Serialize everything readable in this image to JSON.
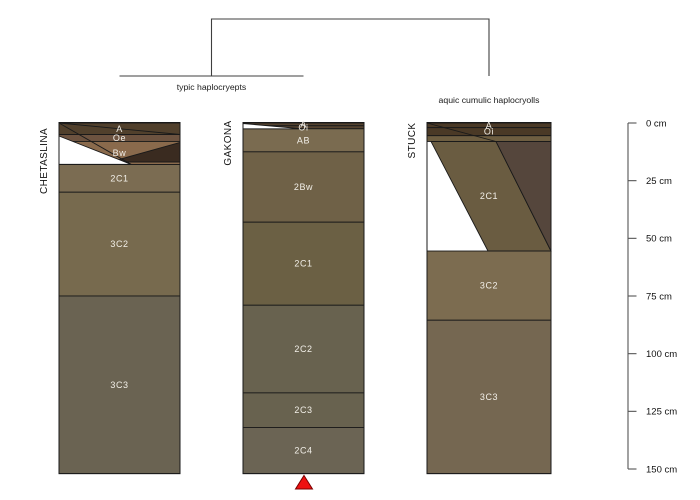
{
  "dendrogram": {
    "group_labels": [
      "typic haplocryepts",
      "aquic cumulic haplocryolls"
    ],
    "groups": [
      {
        "label": "typic haplocryepts",
        "members": [
          "CHETASLINA",
          "GAKONA"
        ]
      },
      {
        "label": "aquic cumulic haplocryolls",
        "members": [
          "STUCK"
        ]
      }
    ],
    "line_color": "#3f3f3f",
    "label_color": "#1a1a1a"
  },
  "depth_axis": {
    "unit": "cm",
    "ticks": [
      {
        "value": 0,
        "label": "0 cm"
      },
      {
        "value": 25,
        "label": "25 cm"
      },
      {
        "value": 50,
        "label": "50 cm"
      },
      {
        "value": 75,
        "label": "75 cm"
      },
      {
        "value": 100,
        "label": "100 cm"
      },
      {
        "value": 125,
        "label": "125 cm"
      },
      {
        "value": 150,
        "label": "150 cm"
      }
    ],
    "line_color": "#555555",
    "label_color": "#111111"
  },
  "profiles": [
    {
      "id": "CHETASLINA",
      "horizons": [
        {
          "name": "A",
          "top_cm": 0,
          "bottom_cm": 5,
          "color": "#51402c"
        },
        {
          "name": "Oe",
          "top_cm": 5,
          "bottom_cm": 8,
          "color": "#6d5340"
        },
        {
          "name": "Bw",
          "top_cm": 8,
          "bottom_cm": 18,
          "color": "#8a6a4c"
        },
        {
          "name": "2C1",
          "top_cm": 18,
          "bottom_cm": 30,
          "color": "#7b6c52"
        },
        {
          "name": "3C2",
          "top_cm": 30,
          "bottom_cm": 75,
          "color": "#776a4e"
        },
        {
          "name": "3C3",
          "top_cm": 75,
          "bottom_cm": 152,
          "color": "#6a6352"
        }
      ]
    },
    {
      "id": "GAKONA",
      "horizons": [
        {
          "name": "A",
          "top_cm": 0,
          "bottom_cm": 1.2,
          "color": "#54422f"
        },
        {
          "name": "Oi",
          "top_cm": 1.2,
          "bottom_cm": 2.5,
          "color": "#54422f"
        },
        {
          "name": "AB",
          "top_cm": 2.5,
          "bottom_cm": 12.5,
          "color": "#7a6b50"
        },
        {
          "name": "2Bw",
          "top_cm": 12.5,
          "bottom_cm": 43,
          "color": "#6f6147"
        },
        {
          "name": "2C1",
          "top_cm": 43,
          "bottom_cm": 79,
          "color": "#6b6044"
        },
        {
          "name": "2C2",
          "top_cm": 79,
          "bottom_cm": 117,
          "color": "#68624f"
        },
        {
          "name": "2C3",
          "top_cm": 117,
          "bottom_cm": 132,
          "color": "#68624f"
        },
        {
          "name": "2C4",
          "top_cm": 132,
          "bottom_cm": 152,
          "color": "#6b6454"
        }
      ]
    },
    {
      "id": "STUCK",
      "horizons": [
        {
          "name": "A",
          "top_cm": 0,
          "bottom_cm": 2,
          "color": "#4a3926"
        },
        {
          "name": "Oi",
          "top_cm": 2,
          "bottom_cm": 5.5,
          "color": "#4a3926"
        },
        {
          "name": "",
          "top_cm": 5.5,
          "bottom_cm": 8,
          "color": "#6e5e41"
        },
        {
          "name": "2C1",
          "top_cm": 8,
          "bottom_cm": 55.5,
          "color": "#6a5c41"
        },
        {
          "name": "3C2",
          "top_cm": 55.5,
          "bottom_cm": 85.5,
          "color": "#7c6c50"
        },
        {
          "name": "3C3",
          "top_cm": 85.5,
          "bottom_cm": 152,
          "color": "#756751"
        }
      ]
    }
  ],
  "overlay_colors": {
    "chetaslina_dark_wedge": "#3a2b20",
    "stuck_dark_wedge": "#55463c",
    "gap_white": "#ffffff"
  },
  "horizon_label_color": "#f2efe8",
  "profile_id_color": "#111111",
  "boundary_line_color": "#1a1a1a",
  "marker": {
    "shape": "triangle-up",
    "color": "#ee1111",
    "border": "#7a0000",
    "profile": "GAKONA"
  }
}
